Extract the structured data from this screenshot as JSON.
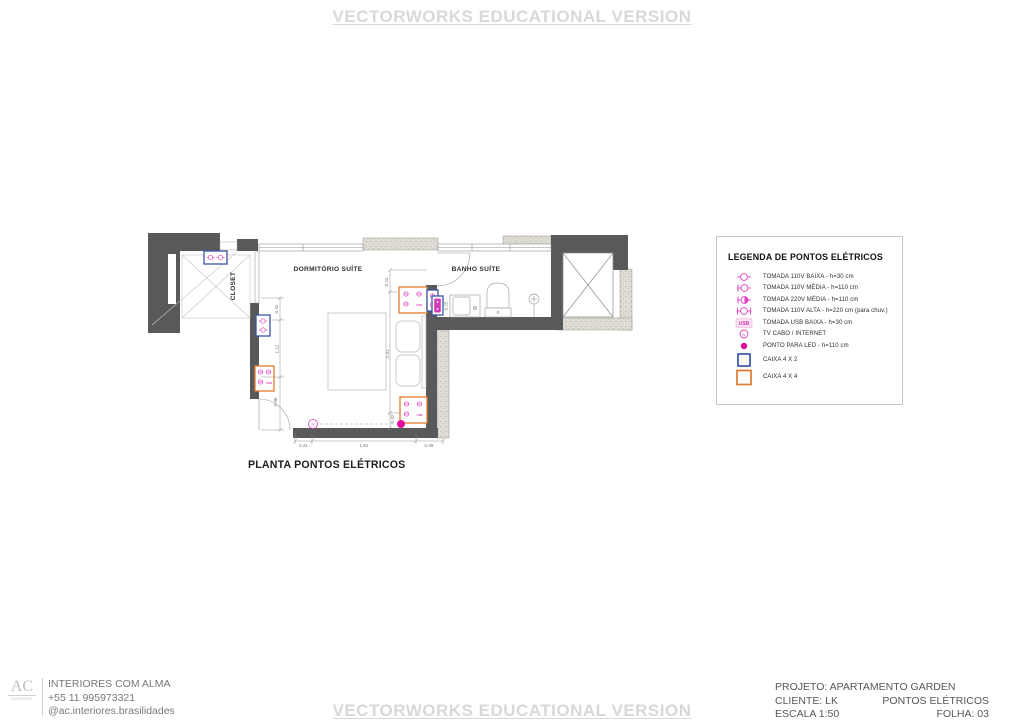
{
  "watermark": {
    "text": "VECTORWORKS EDUCATIONAL VERSION"
  },
  "plan": {
    "title": "PLANTA PONTOS ELÉTRICOS",
    "rooms": {
      "dormitorio": "DORMITÓRIO SUÍTE",
      "banho": "BANHO SUÍTE",
      "closet": "CLOSET"
    },
    "usb_text": "USB",
    "tv_text": "tv",
    "dimensions": {
      "left": [
        "0.42",
        "1.12",
        "0.96"
      ],
      "right": [
        "0.22",
        "2.31",
        "0.32"
      ],
      "bottom": [
        "0.21",
        "1.81",
        "0.49"
      ],
      "bath": "0.25"
    }
  },
  "legend": {
    "title": "LEGENDA DE PONTOS ELÉTRICOS",
    "usb_text": "USB",
    "tv_text": "tv",
    "items": [
      {
        "icon": "outlet-110v-low-icon",
        "label": "TOMADA 110V BAIXA - h=30 cm"
      },
      {
        "icon": "outlet-110v-mid-icon",
        "label": "TOMADA 110V MÉDIA - h=110 cm"
      },
      {
        "icon": "outlet-220v-mid-icon",
        "label": "TOMADA 220V MÉDIA - h=110 cm"
      },
      {
        "icon": "outlet-110v-high-icon",
        "label": "TOMADA 110V ALTA - h=220 cm (para chuv.)"
      },
      {
        "icon": "outlet-usb-low-icon",
        "label": "TOMADA USB BAIXA - h=30 cm"
      },
      {
        "icon": "tv-cable-internet-icon",
        "label": "TV CABO / INTERNET"
      },
      {
        "icon": "led-point-icon",
        "label": "PONTO PARA LED - h=110 cm"
      },
      {
        "icon": "box-4x2-icon",
        "label": "CAIXA 4 X 2"
      },
      {
        "icon": "box-4x4-icon",
        "label": "CAIXA 4 X 4"
      }
    ]
  },
  "footer": {
    "logo": {
      "initials": "AC",
      "subtitle": "interiores"
    },
    "studio_lines": [
      "INTERIORES COM ALMA",
      "+55  11 995973321",
      "@ac.interiores.brasilidades"
    ],
    "project": "PROJETO: APARTAMENTO GARDEN",
    "client": "CLIENTE: LK",
    "sheet_title": "PONTOS ELÉTRICOS",
    "scale": "ESCALA 1:50",
    "sheet": "FOLHA: 03"
  },
  "colors": {
    "wall": "#58595b",
    "outlet": "#e23ec0",
    "led": "#e0109d",
    "box_4x2": "#3a55a6",
    "box_4x4": "#e2792e"
  }
}
